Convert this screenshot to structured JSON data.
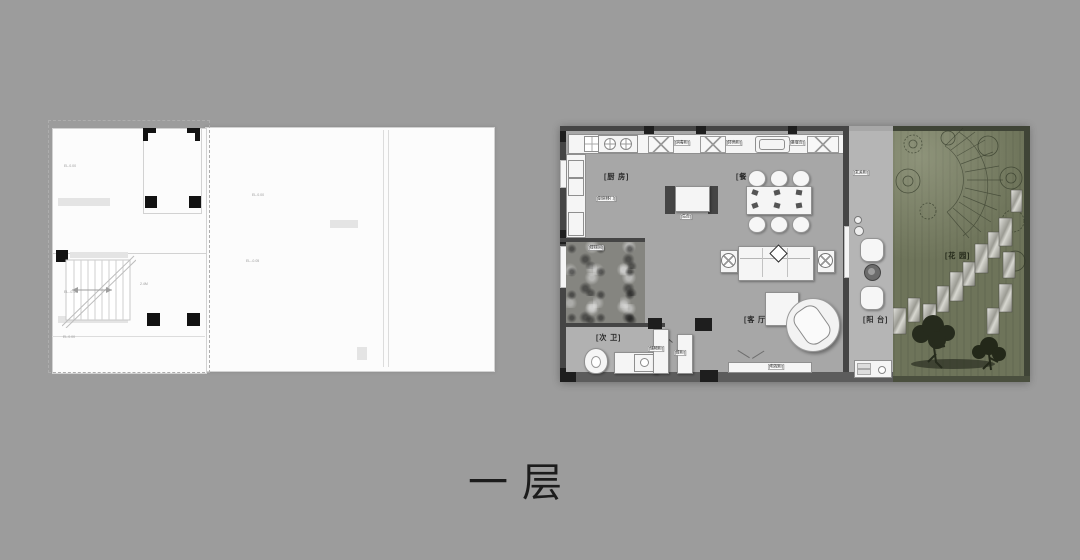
{
  "page": {
    "background": "#9c9c9c",
    "floor_title": "一层"
  },
  "left_plan": {
    "type": "cad-line-drawing",
    "annotations": [
      "EL.0.00",
      "EL.-0.05",
      "EL.0.00",
      "EL.-0.05",
      "2.4M",
      "EL.0.00"
    ]
  },
  "right_plan": {
    "room_labels": {
      "kitchen": "[厨 房]",
      "dining": "[餐 厅]",
      "living": "[客 厅]",
      "bath": "[次 卫]",
      "balcony": "[阳 台]",
      "garden": "[花 园]"
    },
    "cabinet_labels": {
      "hood": "[消毒柜]",
      "corner": "[转角柜]",
      "sideboard": "[备餐台]",
      "kitchen_door": "[厨房移门]",
      "island": "[岛台]",
      "stair": "[楼梯间]",
      "hall_cabinet1": "[储物柜]",
      "hall_cabinet2": "[鞋柜]",
      "entry_cabinet": "[玄关柜]",
      "tv_cabinet": "[电视柜]"
    },
    "colors": {
      "floor": "#a7a7a7",
      "wall": "#454545",
      "garden_green": "#6e745a",
      "furniture": "#f5f5f5",
      "stone": "#d9d9d6"
    }
  }
}
